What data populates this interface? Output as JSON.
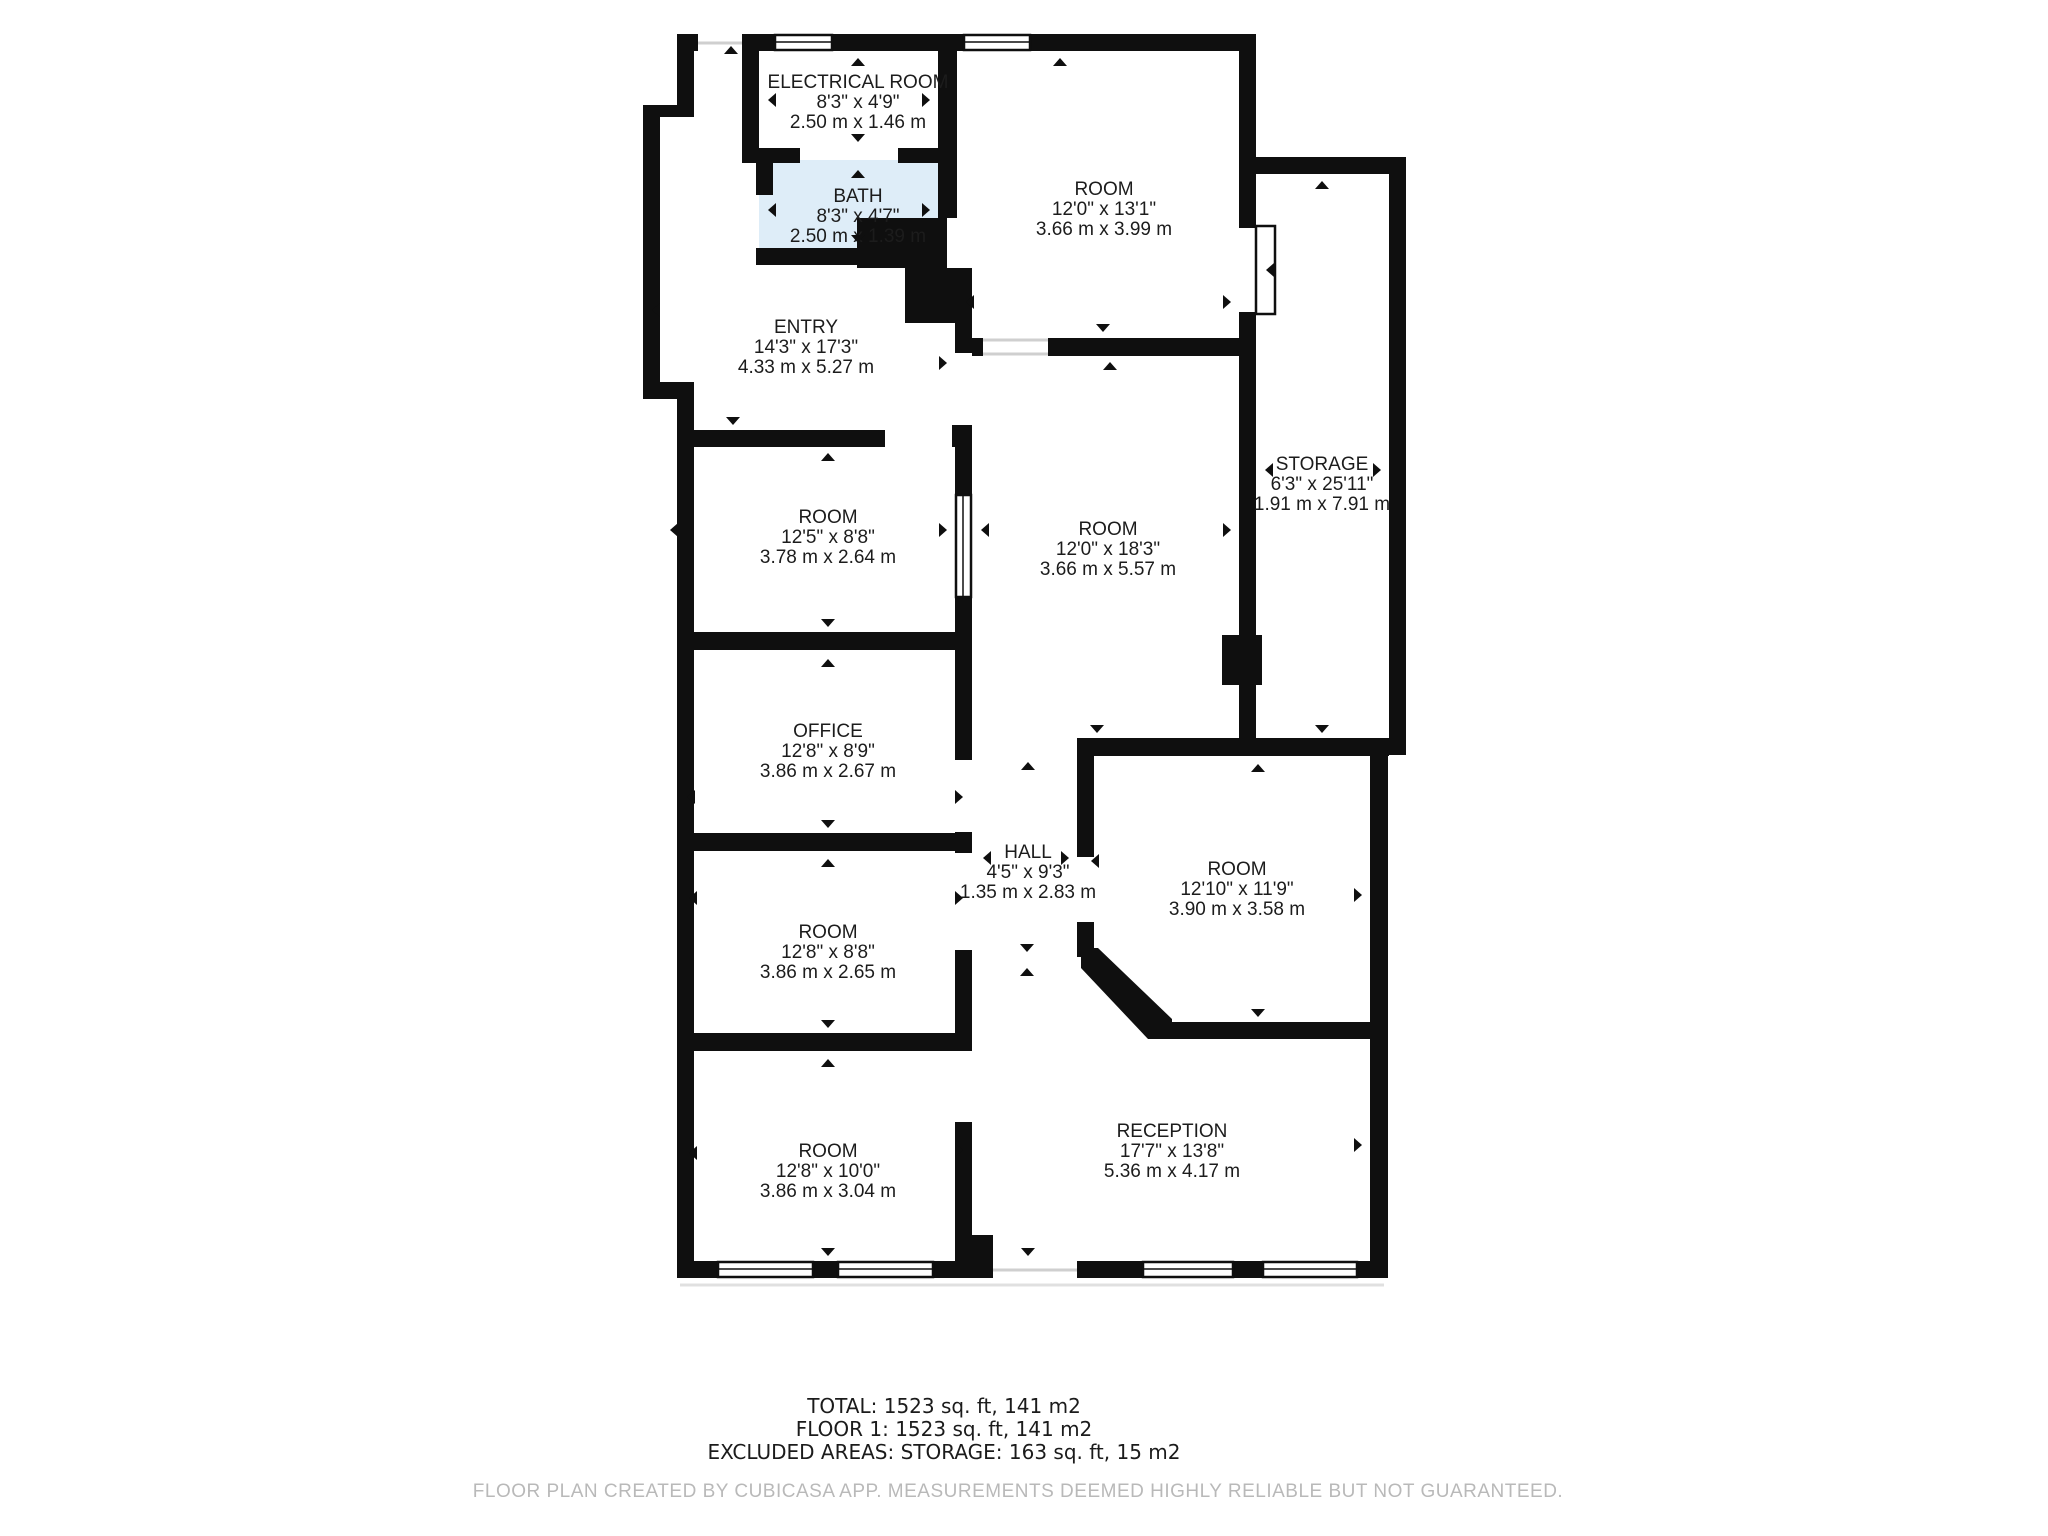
{
  "floorplan": {
    "rooms": [
      {
        "id": "electrical-room",
        "name": "ELECTRICAL ROOM",
        "imperial": "8'3\" x 4'9\"",
        "metric": "2.50 m x 1.46 m"
      },
      {
        "id": "bath",
        "name": "BATH",
        "imperial": "8'3\" x 4'7\"",
        "metric": "2.50 m x 1.39 m"
      },
      {
        "id": "room-ne",
        "name": "ROOM",
        "imperial": "12'0\" x 13'1\"",
        "metric": "3.66 m x 3.99 m"
      },
      {
        "id": "entry",
        "name": "ENTRY",
        "imperial": "14'3\" x 17'3\"",
        "metric": "4.33 m x 5.27 m"
      },
      {
        "id": "storage",
        "name": "STORAGE",
        "imperial": "6'3\" x 25'11\"",
        "metric": "1.91 m x 7.91 m"
      },
      {
        "id": "room-w1",
        "name": "ROOM",
        "imperial": "12'5\" x 8'8\"",
        "metric": "3.78 m x 2.64 m"
      },
      {
        "id": "room-center",
        "name": "ROOM",
        "imperial": "12'0\" x 18'3\"",
        "metric": "3.66 m x 5.57 m"
      },
      {
        "id": "office",
        "name": "OFFICE",
        "imperial": "12'8\" x 8'9\"",
        "metric": "3.86 m x 2.67 m"
      },
      {
        "id": "hall",
        "name": "HALL",
        "imperial": "4'5\" x 9'3\"",
        "metric": "1.35 m x 2.83 m"
      },
      {
        "id": "room-e",
        "name": "ROOM",
        "imperial": "12'10\" x 11'9\"",
        "metric": "3.90 m x 3.58 m"
      },
      {
        "id": "room-w2",
        "name": "ROOM",
        "imperial": "12'8\" x 8'8\"",
        "metric": "3.86 m x 2.65 m"
      },
      {
        "id": "room-w3",
        "name": "ROOM",
        "imperial": "12'8\" x 10'0\"",
        "metric": "3.86 m x 3.04 m"
      },
      {
        "id": "reception",
        "name": "RECEPTION",
        "imperial": "17'7\" x 13'8\"",
        "metric": "5.36 m x 4.17 m"
      }
    ],
    "summary": {
      "total": "TOTAL: 1523 sq. ft, 141 m2",
      "floor": "FLOOR 1: 1523 sq. ft, 141 m2",
      "excluded": "EXCLUDED AREAS: STORAGE: 163 sq. ft, 15 m2"
    },
    "disclaimer": "FLOOR PLAN CREATED BY CUBICASA APP. MEASUREMENTS DEEMED HIGHLY RELIABLE BUT NOT GUARANTEED.",
    "colors": {
      "wall": "#0f0f0f",
      "bath_fill": "#deedf8",
      "label_text": "#1c1c1c",
      "disclaimer_text": "#b9b9b9"
    }
  }
}
